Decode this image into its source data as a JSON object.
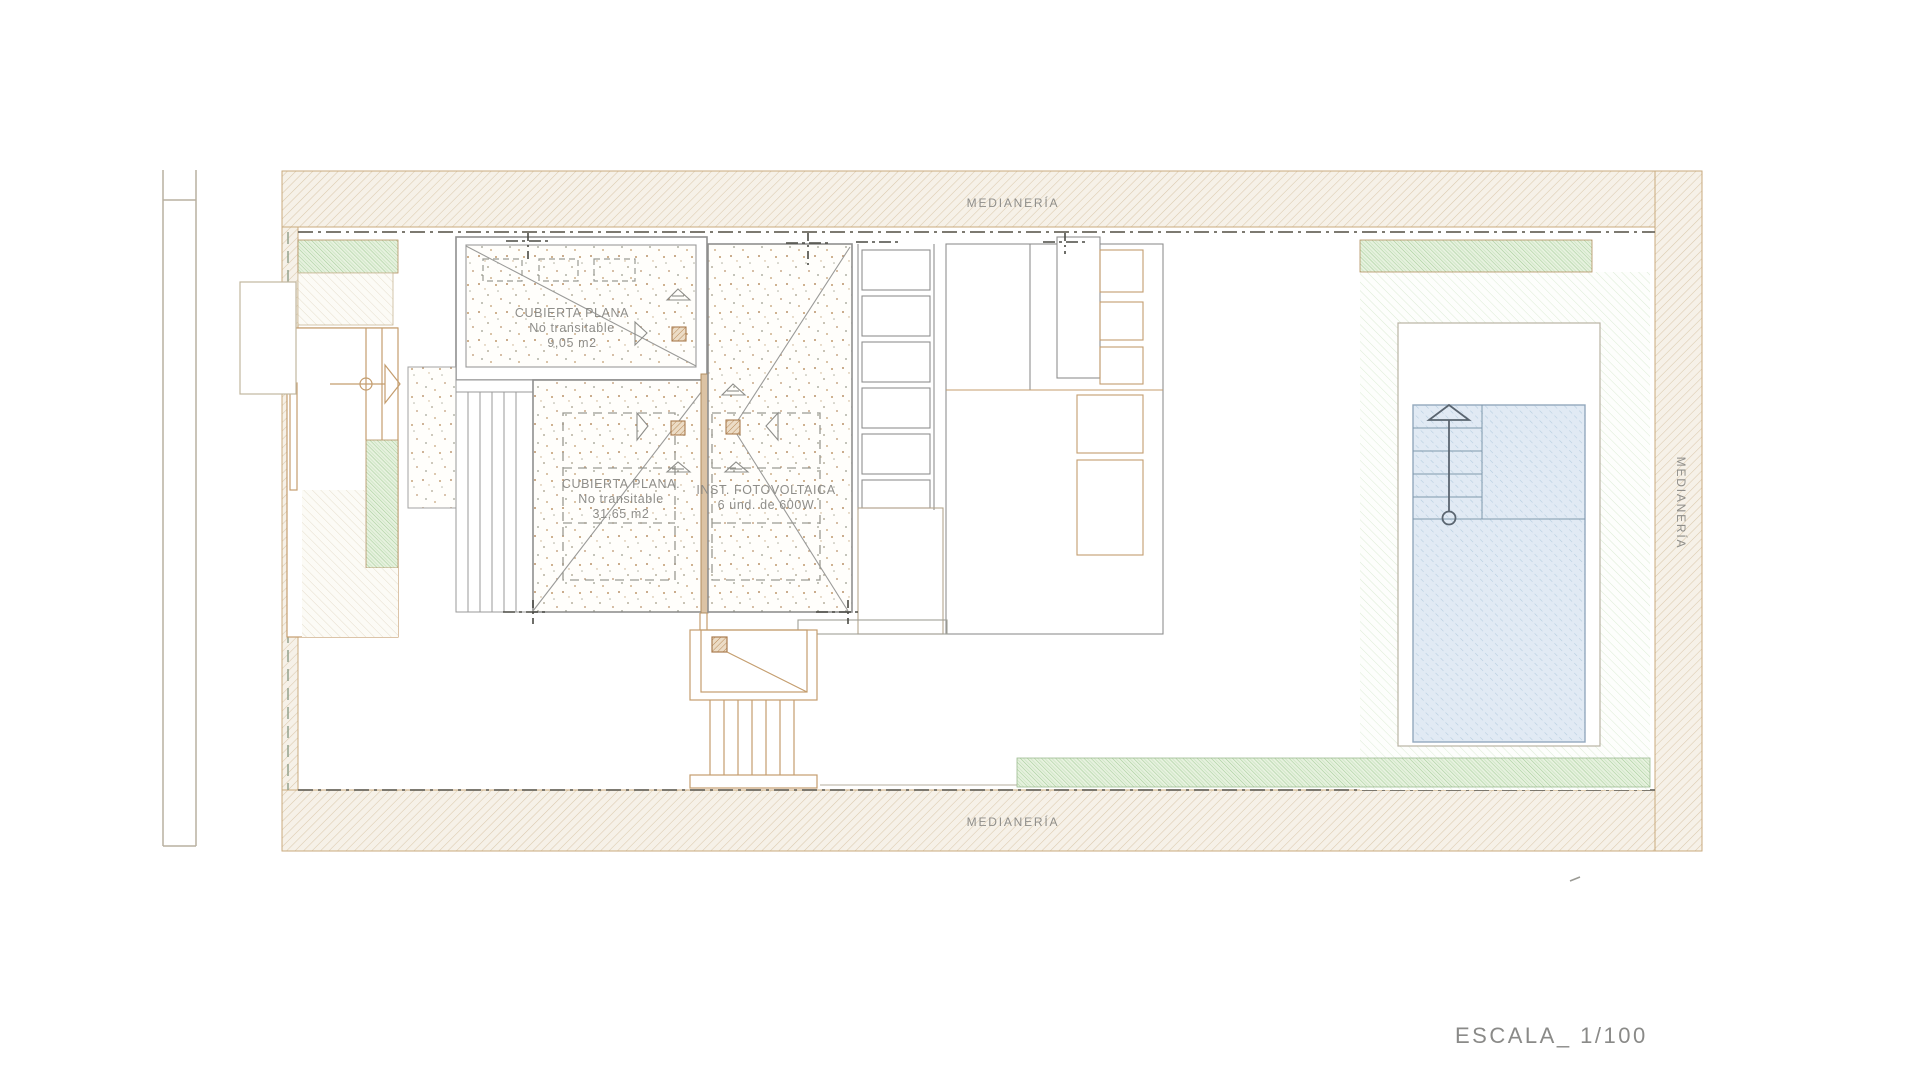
{
  "drawing": {
    "type": "architectural-roof-plan",
    "party_wall_labels": {
      "top": "MEDIANERÍA",
      "bottom": "MEDIANERÍA",
      "right": "MEDIANERÍA"
    },
    "roofs": {
      "small": {
        "title": "CUBIERTA PLANA",
        "subtitle": "No transitable",
        "area": "9,05 m2"
      },
      "main": {
        "title": "CUBIERTA PLANA.",
        "subtitle": "No transitable",
        "area": "31,65 m2"
      },
      "photovoltaic": {
        "title": "INST. FOTOVOLTAICA",
        "subtitle": "6 und. de 600W"
      }
    },
    "scale_label": "ESCALA_ 1/100",
    "colors": {
      "band_hatch": "#dbc9ad",
      "band_bg": "#f6f1e8",
      "green_dense": "#a5cd99",
      "green_light": "#dcebd5",
      "pool_fill": "#e1eaf4",
      "pool_hatch": "#b4cbdf",
      "building_line": "#8f8f8f",
      "site_line": "#c49d6e",
      "text": "#8f8e8a",
      "boundary_line": "#6b675d"
    }
  }
}
